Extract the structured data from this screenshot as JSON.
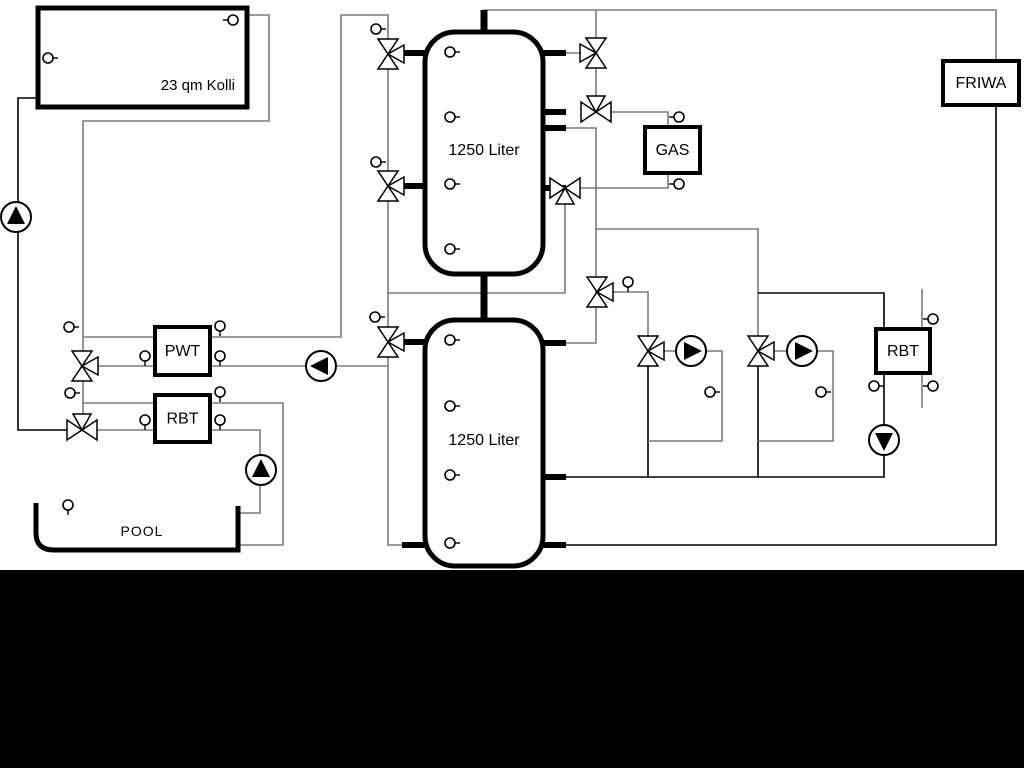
{
  "canvas": {
    "width": 1024,
    "height": 768,
    "background": "#ffffff"
  },
  "bottom_bar": {
    "x": 0,
    "y": 570,
    "width": 1024,
    "height": 198,
    "color": "#000000"
  },
  "colors": {
    "pipe_gray": "#7b7b7b",
    "pipe_black": "#000000",
    "outline": "#000000",
    "fill": "#ffffff"
  },
  "labels": {
    "collector": "23 qm Kolli",
    "tank_upper": "1250 Liter",
    "tank_lower": "1250 Liter",
    "gas": "GAS",
    "friwa": "FRIWA",
    "pwt": "PWT",
    "rbt_left": "RBT",
    "rbt_right": "RBT",
    "pool": "POOL"
  },
  "boxes": [
    {
      "id": "collector",
      "x": 38,
      "y": 8,
      "w": 209,
      "h": 99,
      "sw": 5,
      "key": "collector",
      "tx": 235,
      "ty": 90,
      "anchor": "end",
      "fs": 15
    },
    {
      "id": "gas",
      "x": 645,
      "y": 127,
      "w": 55,
      "h": 46,
      "sw": 4,
      "key": "gas",
      "fs": 16
    },
    {
      "id": "friwa",
      "x": 943,
      "y": 61,
      "w": 76,
      "h": 44,
      "sw": 4,
      "key": "friwa",
      "fs": 16
    },
    {
      "id": "pwt",
      "x": 155,
      "y": 327,
      "w": 55,
      "h": 48,
      "sw": 4,
      "key": "pwt",
      "fs": 16
    },
    {
      "id": "rbt-left",
      "x": 155,
      "y": 395,
      "w": 55,
      "h": 47,
      "sw": 4,
      "key": "rbt_left",
      "fs": 16
    },
    {
      "id": "rbt-right",
      "x": 876,
      "y": 329,
      "w": 54,
      "h": 44,
      "sw": 4,
      "key": "rbt_right",
      "fs": 16
    }
  ],
  "tanks": [
    {
      "id": "tank-upper",
      "x": 425,
      "y": 32,
      "w": 118,
      "h": 242,
      "rx": 30,
      "sw": 5,
      "key": "tank_upper",
      "tx": 484,
      "ty": 155,
      "fs": 16
    },
    {
      "id": "tank-lower",
      "x": 425,
      "y": 320,
      "w": 118,
      "h": 246,
      "rx": 30,
      "sw": 5,
      "key": "tank_lower",
      "tx": 484,
      "ty": 445,
      "fs": 16
    }
  ],
  "pool": {
    "path": "M 36 503 L 36 533 Q 36 550 54 550 L 238 550 L 238 506",
    "sw": 5,
    "key": "pool",
    "tx": 142,
    "ty": 536,
    "fs": 14
  },
  "pipes": [
    {
      "c": "g",
      "pts": [
        [
          247,
          15
        ],
        [
          269,
          15
        ],
        [
          269,
          121
        ],
        [
          83,
          121
        ],
        [
          83,
          430
        ]
      ]
    },
    {
      "c": "g",
      "pts": [
        [
          83,
          337
        ],
        [
          155,
          337
        ]
      ]
    },
    {
      "c": "g",
      "pts": [
        [
          82,
          366
        ],
        [
          155,
          366
        ]
      ]
    },
    {
      "c": "g",
      "pts": [
        [
          83,
          403
        ],
        [
          155,
          403
        ]
      ]
    },
    {
      "c": "g",
      "pts": [
        [
          82,
          430
        ],
        [
          155,
          430
        ]
      ]
    },
    {
      "c": "k",
      "pts": [
        [
          37,
          98
        ],
        [
          18,
          98
        ],
        [
          18,
          430
        ],
        [
          82,
          430
        ]
      ]
    },
    {
      "c": "g",
      "pts": [
        [
          210,
          337
        ],
        [
          341,
          337
        ],
        [
          341,
          15
        ],
        [
          388,
          15
        ],
        [
          388,
          342
        ]
      ]
    },
    {
      "c": "g",
      "pts": [
        [
          210,
          366
        ],
        [
          388,
          366
        ],
        [
          388,
          545
        ],
        [
          425,
          545
        ]
      ]
    },
    {
      "c": "g",
      "pts": [
        [
          388,
          342
        ],
        [
          388,
          366
        ]
      ]
    },
    {
      "c": "g",
      "pts": [
        [
          210,
          403
        ],
        [
          283,
          403
        ],
        [
          283,
          545
        ],
        [
          240,
          545
        ]
      ]
    },
    {
      "c": "g",
      "pts": [
        [
          210,
          430
        ],
        [
          260,
          430
        ],
        [
          260,
          513
        ],
        [
          240,
          513
        ]
      ]
    },
    {
      "c": "g",
      "pts": [
        [
          388,
          293
        ],
        [
          565,
          293
        ],
        [
          565,
          188
        ]
      ]
    },
    {
      "c": "g",
      "pts": [
        [
          484,
          10
        ],
        [
          996,
          10
        ],
        [
          996,
          61
        ]
      ]
    },
    {
      "c": "g",
      "pts": [
        [
          596,
          10
        ],
        [
          596,
          112
        ]
      ]
    },
    {
      "c": "g",
      "pts": [
        [
          566,
          53
        ],
        [
          596,
          53
        ]
      ]
    },
    {
      "c": "g",
      "pts": [
        [
          596,
          112
        ],
        [
          668,
          112
        ],
        [
          668,
          127
        ]
      ]
    },
    {
      "c": "g",
      "pts": [
        [
          668,
          173
        ],
        [
          668,
          188
        ],
        [
          565,
          188
        ]
      ]
    },
    {
      "c": "g",
      "pts": [
        [
          566,
          128
        ],
        [
          596,
          128
        ],
        [
          596,
          292
        ]
      ]
    },
    {
      "c": "g",
      "pts": [
        [
          596,
          229
        ],
        [
          758,
          229
        ],
        [
          758,
          351
        ]
      ]
    },
    {
      "c": "g",
      "pts": [
        [
          597,
          292
        ],
        [
          648,
          292
        ],
        [
          648,
          351
        ]
      ]
    },
    {
      "c": "g",
      "pts": [
        [
          596,
          292
        ],
        [
          596,
          343
        ],
        [
          566,
          343
        ]
      ]
    },
    {
      "c": "k",
      "pts": [
        [
          648,
          351
        ],
        [
          648,
          477
        ]
      ]
    },
    {
      "c": "k",
      "pts": [
        [
          758,
          351
        ],
        [
          758,
          477
        ]
      ]
    },
    {
      "c": "g",
      "pts": [
        [
          648,
          351
        ],
        [
          676,
          351
        ]
      ]
    },
    {
      "c": "g",
      "pts": [
        [
          691,
          351
        ],
        [
          722,
          351
        ],
        [
          722,
          441
        ],
        [
          648,
          441
        ]
      ]
    },
    {
      "c": "g",
      "pts": [
        [
          758,
          351
        ],
        [
          787,
          351
        ]
      ]
    },
    {
      "c": "g",
      "pts": [
        [
          802,
          351
        ],
        [
          833,
          351
        ],
        [
          833,
          441
        ],
        [
          758,
          441
        ]
      ]
    },
    {
      "c": "k",
      "pts": [
        [
          566,
          477
        ],
        [
          884,
          477
        ],
        [
          884,
          455
        ]
      ]
    },
    {
      "c": "k",
      "pts": [
        [
          758,
          293
        ],
        [
          884,
          293
        ],
        [
          884,
          329
        ]
      ]
    },
    {
      "c": "k",
      "pts": [
        [
          884,
          373
        ],
        [
          884,
          425
        ]
      ]
    },
    {
      "c": "g",
      "pts": [
        [
          922,
          289
        ],
        [
          922,
          329
        ]
      ]
    },
    {
      "c": "g",
      "pts": [
        [
          922,
          373
        ],
        [
          922,
          408
        ]
      ]
    },
    {
      "c": "k",
      "pts": [
        [
          566,
          545
        ],
        [
          996,
          545
        ],
        [
          996,
          105
        ]
      ]
    }
  ],
  "stubs": [
    {
      "pts": [
        [
          484,
          10
        ],
        [
          484,
          34
        ]
      ],
      "w": 7
    },
    {
      "pts": [
        [
          484,
          272
        ],
        [
          484,
          322
        ]
      ],
      "w": 7
    },
    {
      "pts": [
        [
          398,
          53
        ],
        [
          427,
          53
        ]
      ],
      "w": 6
    },
    {
      "pts": [
        [
          398,
          186
        ],
        [
          427,
          186
        ]
      ],
      "w": 6
    },
    {
      "pts": [
        [
          541,
          53
        ],
        [
          566,
          53
        ]
      ],
      "w": 6
    },
    {
      "pts": [
        [
          541,
          112
        ],
        [
          566,
          112
        ]
      ],
      "w": 6
    },
    {
      "pts": [
        [
          541,
          128
        ],
        [
          566,
          128
        ]
      ],
      "w": 6
    },
    {
      "pts": [
        [
          541,
          188
        ],
        [
          566,
          188
        ]
      ],
      "w": 6
    },
    {
      "pts": [
        [
          398,
          342
        ],
        [
          427,
          342
        ]
      ],
      "w": 6
    },
    {
      "pts": [
        [
          402,
          545
        ],
        [
          427,
          545
        ]
      ],
      "w": 6
    },
    {
      "pts": [
        [
          541,
          343
        ],
        [
          566,
          343
        ]
      ],
      "w": 6
    },
    {
      "pts": [
        [
          541,
          477
        ],
        [
          566,
          477
        ]
      ],
      "w": 6
    },
    {
      "pts": [
        [
          541,
          545
        ],
        [
          566,
          545
        ]
      ],
      "w": 6
    }
  ],
  "valves": [
    {
      "x": 596,
      "y": 53,
      "axis": "v",
      "third": "left"
    },
    {
      "x": 596,
      "y": 112,
      "axis": "h",
      "third": "top"
    },
    {
      "x": 565,
      "y": 188,
      "axis": "h",
      "third": "bottom"
    },
    {
      "x": 597,
      "y": 292,
      "axis": "v",
      "third": "right"
    },
    {
      "x": 648,
      "y": 351,
      "axis": "v",
      "third": "right"
    },
    {
      "x": 758,
      "y": 351,
      "axis": "v",
      "third": "right"
    },
    {
      "x": 82,
      "y": 366,
      "axis": "v",
      "third": "right"
    },
    {
      "x": 82,
      "y": 430,
      "axis": "h",
      "third": "top"
    },
    {
      "x": 388,
      "y": 54,
      "axis": "v",
      "third": "right"
    },
    {
      "x": 388,
      "y": 186,
      "axis": "v",
      "third": "right"
    },
    {
      "x": 388,
      "y": 342,
      "axis": "v",
      "third": "right"
    }
  ],
  "pumps": [
    {
      "x": 16,
      "y": 217,
      "dir": "up"
    },
    {
      "x": 261,
      "y": 470,
      "dir": "up"
    },
    {
      "x": 321,
      "y": 366,
      "dir": "left"
    },
    {
      "x": 691,
      "y": 351,
      "dir": "right"
    },
    {
      "x": 802,
      "y": 351,
      "dir": "right"
    },
    {
      "x": 884,
      "y": 440,
      "dir": "down"
    }
  ],
  "sensors": [
    {
      "x": 233,
      "y": 20,
      "d": "l"
    },
    {
      "x": 48,
      "y": 58,
      "d": "r"
    },
    {
      "x": 450,
      "y": 52,
      "d": "r"
    },
    {
      "x": 450,
      "y": 117,
      "d": "r"
    },
    {
      "x": 450,
      "y": 184,
      "d": "r"
    },
    {
      "x": 450,
      "y": 249,
      "d": "r"
    },
    {
      "x": 450,
      "y": 340,
      "d": "r"
    },
    {
      "x": 450,
      "y": 406,
      "d": "r"
    },
    {
      "x": 450,
      "y": 475,
      "d": "r"
    },
    {
      "x": 450,
      "y": 543,
      "d": "r"
    },
    {
      "x": 376,
      "y": 29,
      "d": "r"
    },
    {
      "x": 376,
      "y": 162,
      "d": "r"
    },
    {
      "x": 375,
      "y": 317,
      "d": "r"
    },
    {
      "x": 69,
      "y": 327,
      "d": "r"
    },
    {
      "x": 70,
      "y": 393,
      "d": "r"
    },
    {
      "x": 145,
      "y": 356,
      "d": "d"
    },
    {
      "x": 220,
      "y": 326,
      "d": "d"
    },
    {
      "x": 220,
      "y": 356,
      "d": "d"
    },
    {
      "x": 145,
      "y": 420,
      "d": "d"
    },
    {
      "x": 220,
      "y": 392,
      "d": "d"
    },
    {
      "x": 220,
      "y": 420,
      "d": "d"
    },
    {
      "x": 679,
      "y": 117,
      "d": "l"
    },
    {
      "x": 679,
      "y": 184,
      "d": "l"
    },
    {
      "x": 628,
      "y": 282,
      "d": "d"
    },
    {
      "x": 710,
      "y": 392,
      "d": "r"
    },
    {
      "x": 821,
      "y": 392,
      "d": "r"
    },
    {
      "x": 874,
      "y": 386,
      "d": "r"
    },
    {
      "x": 933,
      "y": 319,
      "d": "l"
    },
    {
      "x": 933,
      "y": 386,
      "d": "l"
    },
    {
      "x": 68,
      "y": 505,
      "d": "d"
    }
  ]
}
